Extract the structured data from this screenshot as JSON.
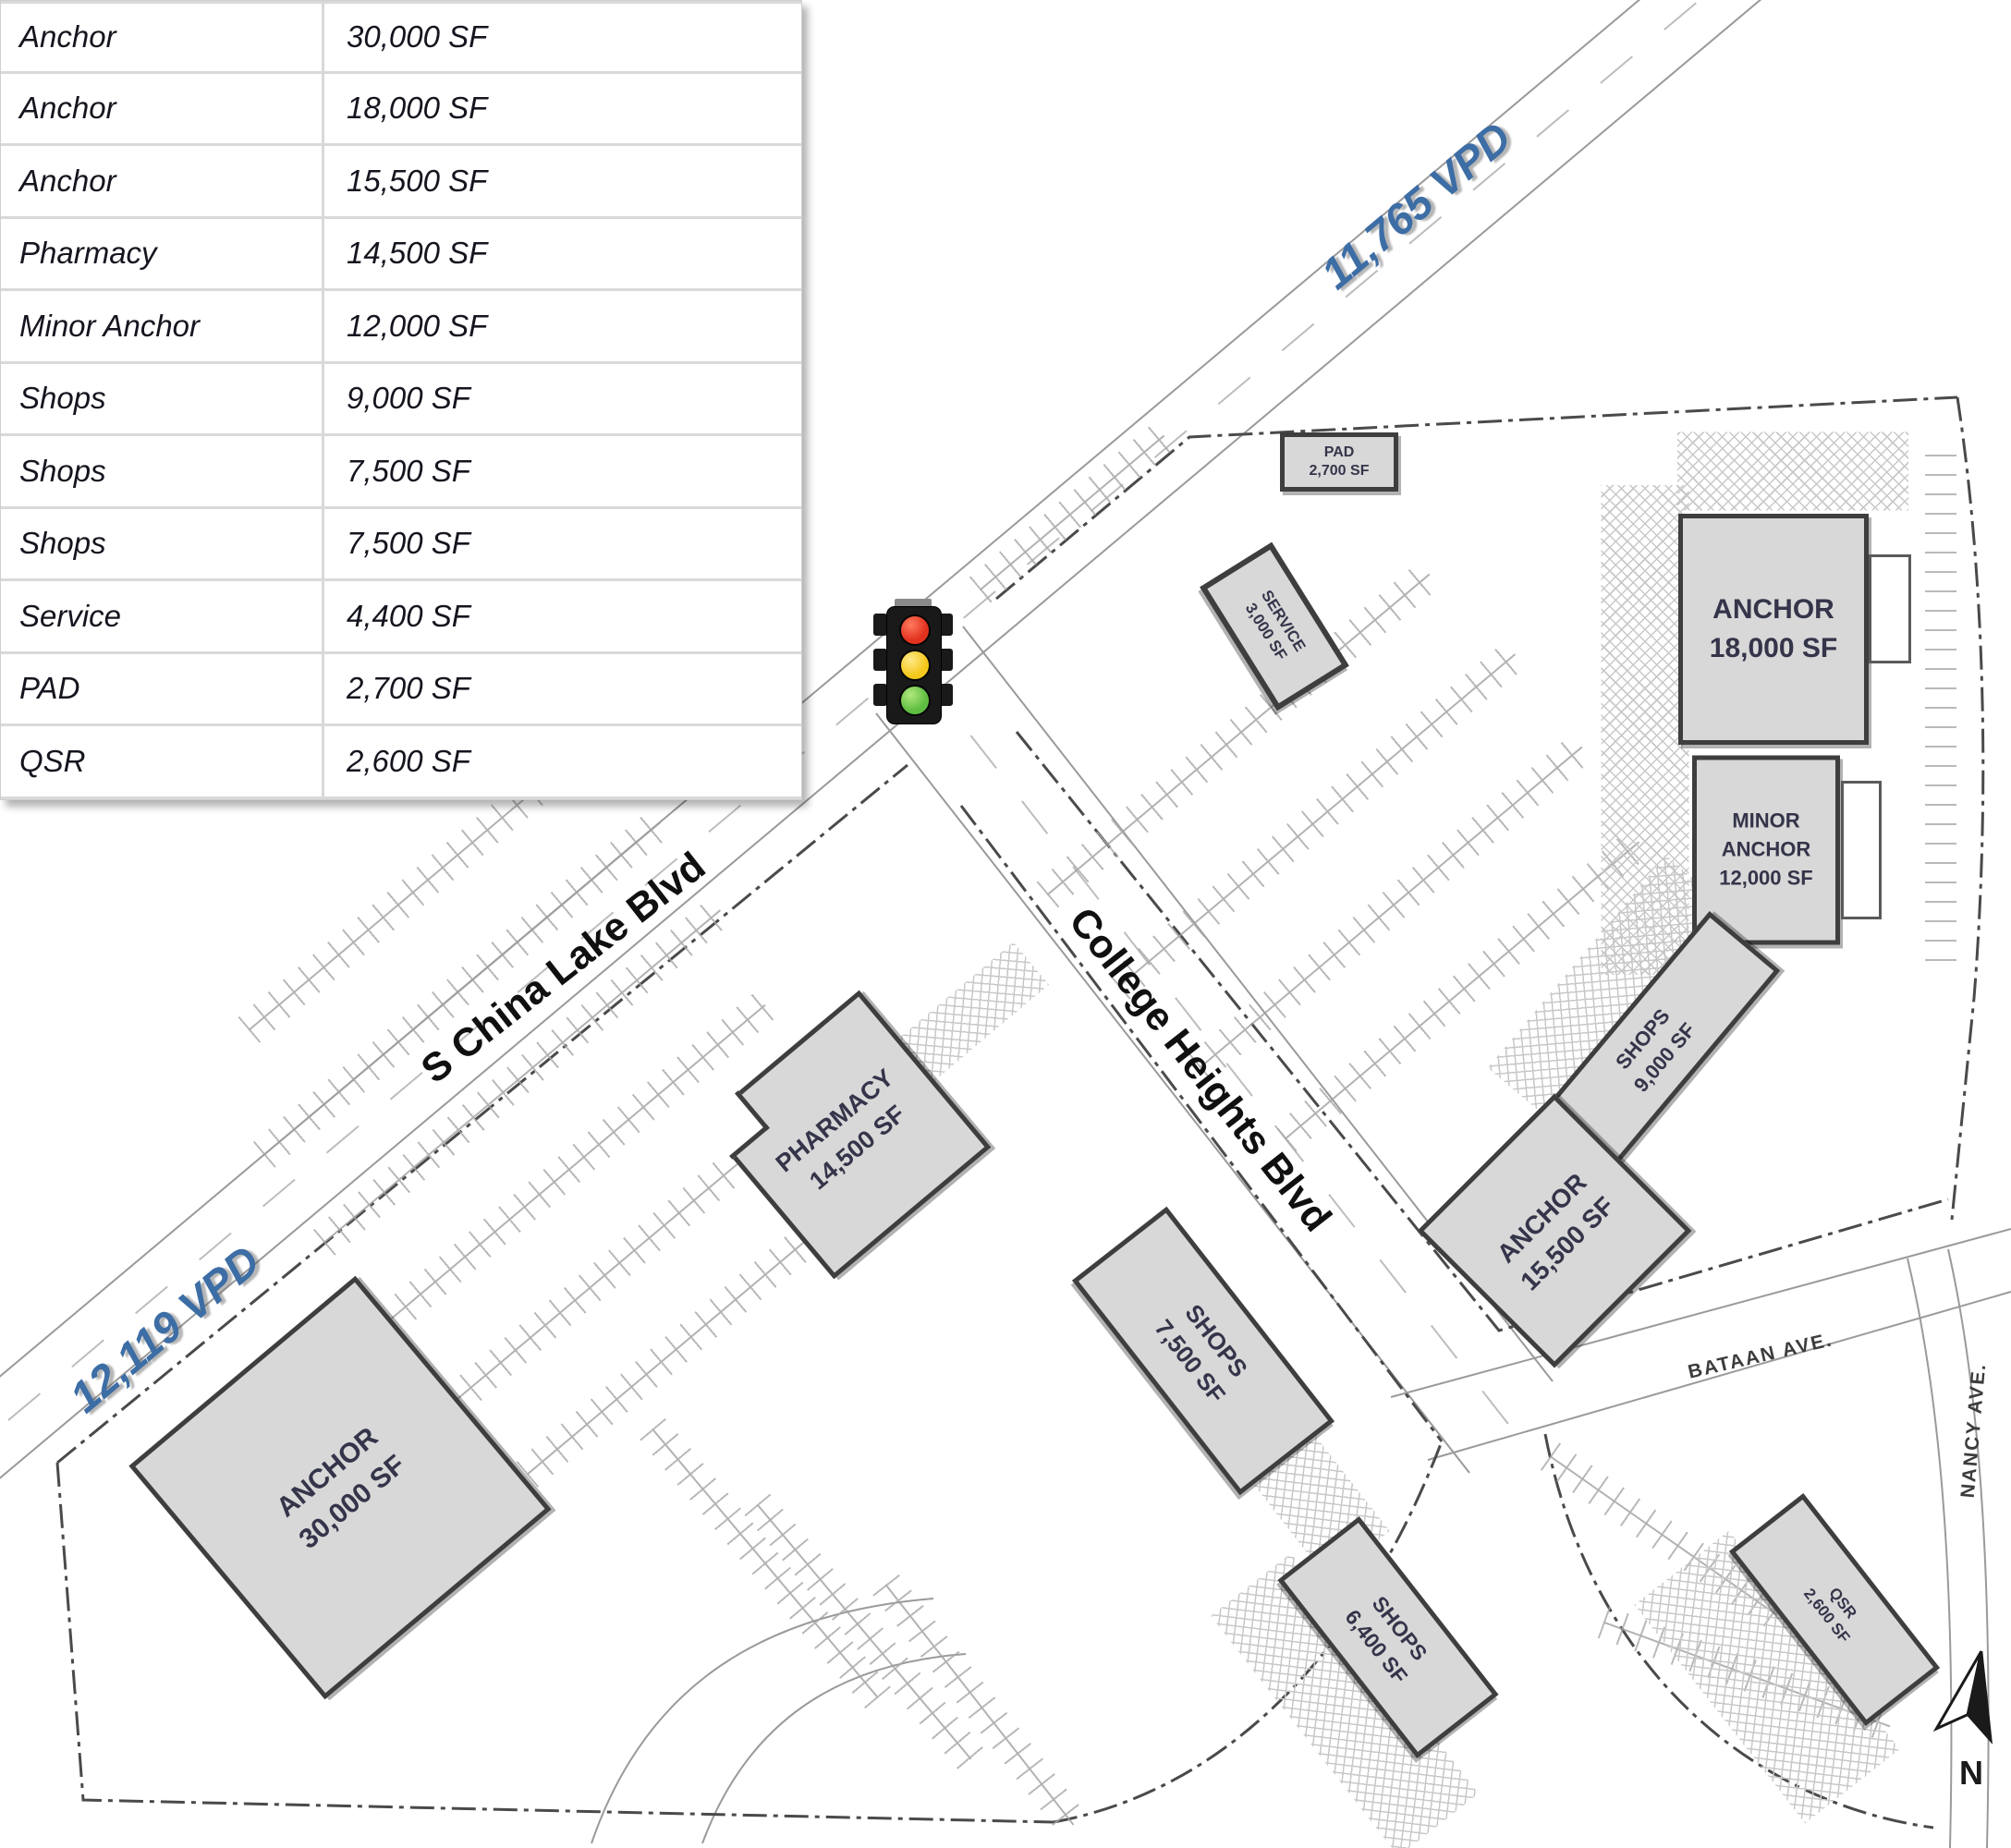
{
  "theme": {
    "accent_blue": "#3d6da5",
    "road_gray": "#9a9a9a",
    "boundary_gray": "#4a4a4a",
    "bldg_fill": "#d8d8d8",
    "bldg_border": "#3e3e3e",
    "bldg_text": "#34344a",
    "light_red": "#e2321f",
    "light_yellow": "#f4c81c",
    "light_green": "#5fbe41"
  },
  "legend": {
    "rows": [
      {
        "label": "Anchor",
        "size": "30,000 SF"
      },
      {
        "label": "Anchor",
        "size": "18,000 SF"
      },
      {
        "label": "Anchor",
        "size": "15,500 SF"
      },
      {
        "label": "Pharmacy",
        "size": "14,500 SF"
      },
      {
        "label": "Minor Anchor",
        "size": "12,000 SF"
      },
      {
        "label": "Shops",
        "size": "9,000 SF"
      },
      {
        "label": "Shops",
        "size": "7,500 SF"
      },
      {
        "label": "Shops",
        "size": "7,500 SF"
      },
      {
        "label": "Service",
        "size": "4,400 SF"
      },
      {
        "label": "PAD",
        "size": "2,700 SF"
      },
      {
        "label": "QSR",
        "size": "2,600 SF"
      }
    ]
  },
  "map": {
    "traffic_volumes": {
      "northeast": "11,765 VPD",
      "southwest": "12,119 VPD"
    },
    "streets": {
      "china_lake": "S China Lake Blvd",
      "college_heights": "College Heights Blvd",
      "bataan": "BATAAN AVE.",
      "nancy": "NANCY AVE."
    },
    "north": "N",
    "buildings": [
      {
        "id": "anchor-30000",
        "lines": [
          "ANCHOR",
          "30,000 SF"
        ]
      },
      {
        "id": "pharmacy",
        "lines": [
          "PHARMACY",
          "14,500 SF"
        ]
      },
      {
        "id": "shops-7500",
        "lines": [
          "SHOPS",
          "7,500 SF"
        ]
      },
      {
        "id": "shops-6400",
        "lines": [
          "SHOPS",
          "6,400 SF"
        ]
      },
      {
        "id": "anchor-18000",
        "lines": [
          "ANCHOR",
          "18,000 SF"
        ]
      },
      {
        "id": "minor-anchor",
        "lines": [
          "MINOR",
          "ANCHOR",
          "12,000 SF"
        ]
      },
      {
        "id": "shops-9000",
        "lines": [
          "SHOPS",
          "9,000 SF"
        ]
      },
      {
        "id": "anchor-15500",
        "lines": [
          "ANCHOR",
          "15,500 SF"
        ]
      },
      {
        "id": "service",
        "lines": [
          "SERVICE",
          "3,000 SF"
        ]
      },
      {
        "id": "pad",
        "lines": [
          "PAD",
          "2,700 SF"
        ]
      },
      {
        "id": "qsr",
        "lines": [
          "QSR",
          "2,600 SF"
        ]
      }
    ]
  }
}
